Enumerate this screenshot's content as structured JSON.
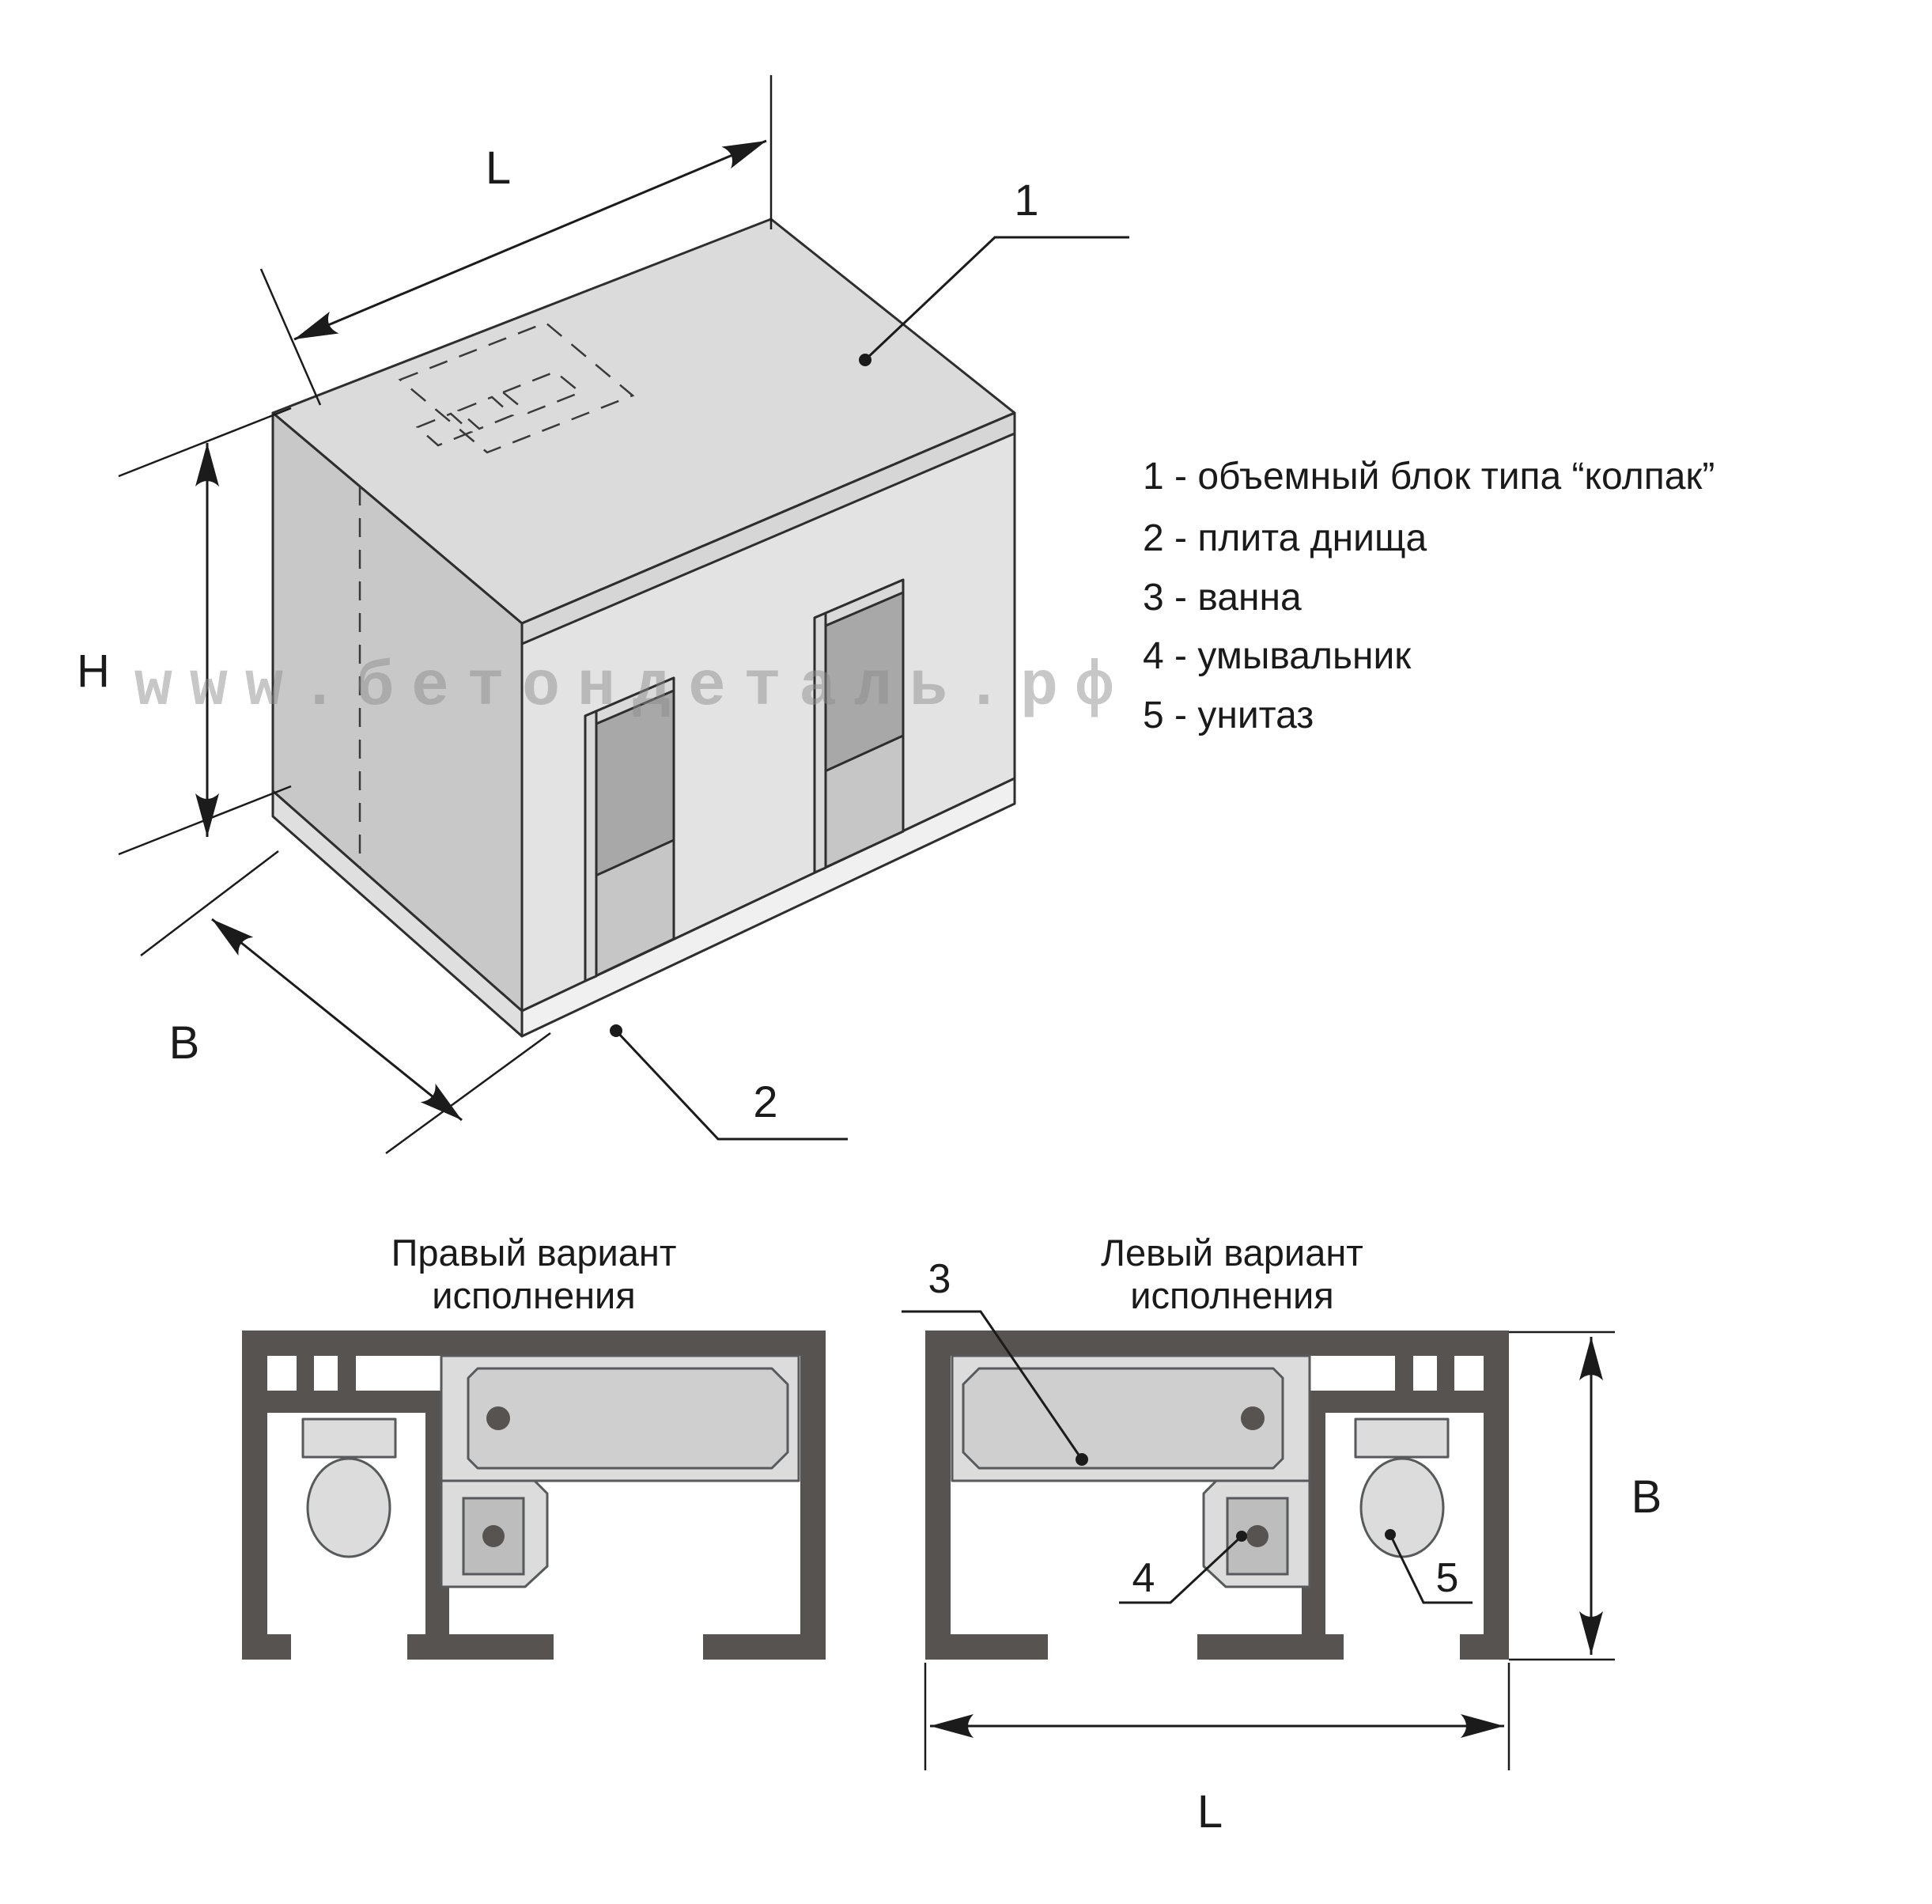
{
  "watermark": {
    "text": "www.бетондеталь.рф"
  },
  "isometric_view": {
    "dim_length_label": "L",
    "dim_height_label": "H",
    "dim_depth_label": "B",
    "leader_block_label": "1",
    "leader_slab_label": "2"
  },
  "legend": {
    "items": [
      {
        "label": "1 - объемный блок типа “колпак”"
      },
      {
        "label": "2 - плита днища"
      },
      {
        "label": "3 - ванна"
      },
      {
        "label": "4 - умывальник"
      },
      {
        "label": "5 - унитаз"
      }
    ]
  },
  "plan_right_variant": {
    "title_line1": "Правый вариант",
    "title_line2": "исполнения"
  },
  "plan_left_variant": {
    "title_line1": "Левый вариант",
    "title_line2": "исполнения",
    "leader_bath_label": "3",
    "leader_washbasin_label": "4",
    "leader_toilet_label": "5",
    "dim_depth_label": "B",
    "dim_length_label": "L"
  },
  "colors": {
    "wall": "#575351",
    "line": "#1B1B1B",
    "fixture_light": "#DCDCDC",
    "tub_inner": "#CFCFCF",
    "basin_inner": "#BDBDBD",
    "iso_top": "#DBDBDB",
    "iso_left": "#C8C8C8",
    "iso_front": "#E3E3E3",
    "watermark": "#8C8C8C"
  }
}
